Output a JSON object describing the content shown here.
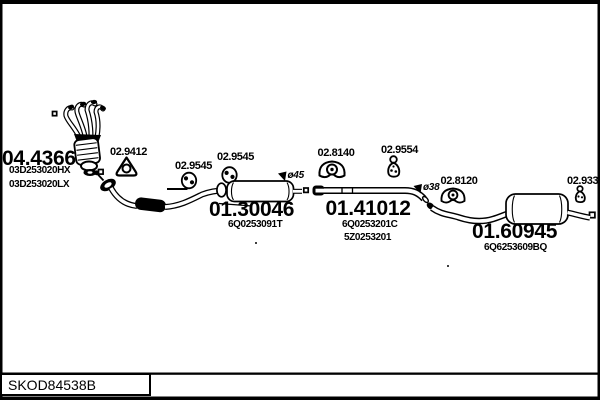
{
  "colors": {
    "ink": "#000000",
    "paper": "#ffffff"
  },
  "footer": {
    "catalog_code": "SKOD84538B"
  },
  "assemblies": {
    "manifold_cat": {
      "code": "04.4366",
      "oe_numbers": [
        "03D253020HX",
        "03D253020LX"
      ],
      "icon": "manifold-catalyst-drawing"
    },
    "centre_muffler": {
      "code": "01.30046",
      "oe_numbers": [
        "6Q0253091T"
      ],
      "diameter_label": "ø45",
      "icon": "centre-muffler-drawing"
    },
    "centre_pipe": {
      "code": "01.41012",
      "oe_numbers": [
        "6Q0253201C",
        "5Z0253201"
      ],
      "diameter_label": "ø38",
      "icon": "centre-pipe-drawing"
    },
    "rear_muffler": {
      "code": "01.60945",
      "oe_numbers": [
        "6Q6253609BQ"
      ],
      "icon": "rear-muffler-drawing"
    }
  },
  "fittings": {
    "gasket": {
      "code": "02.9412",
      "icon": "gasket-triangle-icon"
    },
    "hanger_front_a": {
      "code": "02.9545",
      "icon": "rubber-hanger-icon"
    },
    "hanger_front_b": {
      "code": "02.9545",
      "icon": "rubber-hanger-icon"
    },
    "clamp_centre": {
      "code": "02.8140",
      "icon": "clamp-bracket-icon"
    },
    "hanger_centre": {
      "code": "02.9554",
      "icon": "pear-hanger-icon"
    },
    "clamp_rear": {
      "code": "02.8120",
      "icon": "clamp-bracket-icon"
    },
    "hanger_rear": {
      "code": "02.9335",
      "icon": "pear-hanger-icon"
    }
  }
}
